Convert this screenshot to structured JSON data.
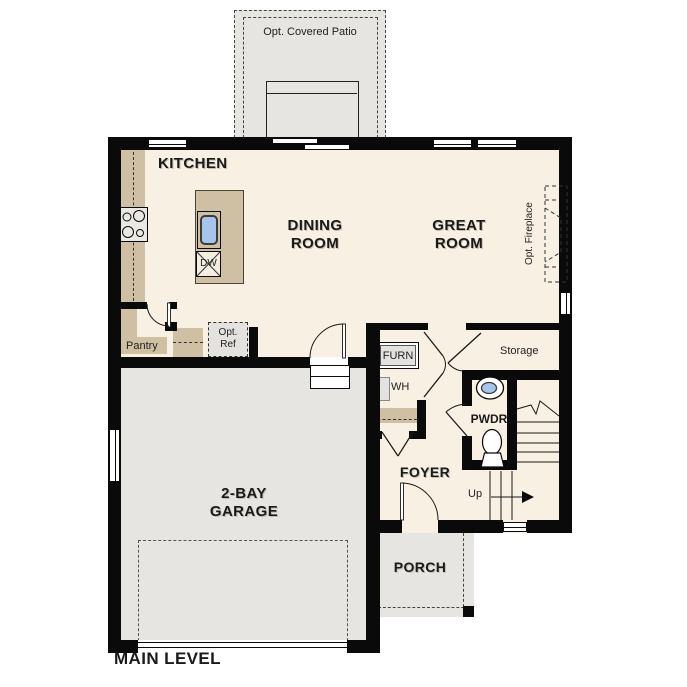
{
  "plan_title": "MAIN LEVEL",
  "rooms": {
    "kitchen": "KITCHEN",
    "dining": {
      "l1": "DINING",
      "l2": "ROOM"
    },
    "great": {
      "l1": "GREAT",
      "l2": "ROOM"
    },
    "garage": {
      "l1": "2-BAY",
      "l2": "GARAGE"
    },
    "foyer": "FOYER",
    "porch": "PORCH",
    "powder": "PWDR",
    "storage": "Storage",
    "pantry": "Pantry"
  },
  "options": {
    "covered_patio": "Opt. Covered Patio",
    "fireplace": "Opt. Fireplace",
    "refrigerator": {
      "l1": "Opt.",
      "l2": "Ref"
    }
  },
  "equipment": {
    "furnace": "FURN",
    "water_heater": "WH",
    "dishwasher": "DW"
  },
  "stairs": {
    "direction": "Up"
  },
  "colors": {
    "floor": "#f8f0e2",
    "concrete": "#e6e5e2",
    "counter": "#cfc0a4",
    "wall": "#0a0a0a",
    "sink_water": "#a5c6e8",
    "appliance": "#e7e6e3"
  }
}
